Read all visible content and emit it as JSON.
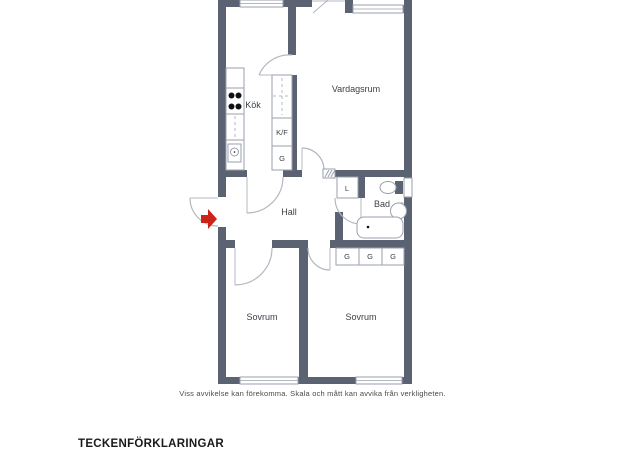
{
  "floorplan": {
    "rooms": {
      "kok": "Kök",
      "vardagsrum": "Vardagsrum",
      "hall": "Hall",
      "bad": "Bad",
      "sovrum_left": "Sovrum",
      "sovrum_right": "Sovrum"
    },
    "storage": {
      "kf": "K/F",
      "g_kitchen": "G",
      "l": "L",
      "g1": "G",
      "g2": "G",
      "g3": "G"
    },
    "colors": {
      "wall": "#5b6272",
      "fixture_outline": "#9aa1ac",
      "door_arc": "#b3b8c0",
      "entry_arrow": "#cc2418",
      "label_text": "#3b3f45"
    }
  },
  "footer": {
    "disclaimer": "Viss avvikelse kan förekomma. Skala och mått kan avvika från verkligheten.",
    "legend_heading": "TECKENFÖRKLARINGAR"
  }
}
